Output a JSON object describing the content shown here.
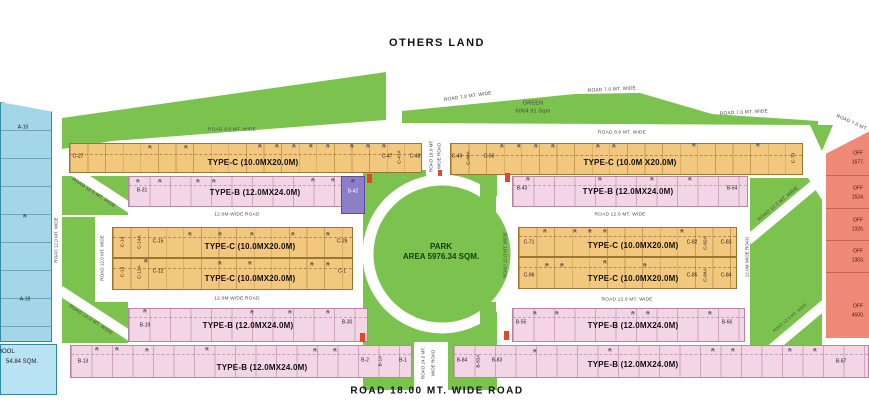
{
  "labels": {
    "others_land": "OTHERS LAND",
    "r": "R",
    "bottom_road": "ROAD 18.00 MT. WIDE ROAD",
    "green_name": "GREEN",
    "green_area": "6064.91 Sqm",
    "park1": "PARK",
    "park2": "AREA 5976.34 SQM."
  },
  "roads": {
    "r7": "ROAD 7.0 MT. WIDE",
    "r8": "ROAD 8.0 MT. WIDE",
    "r9": "ROAD 9.0 MT. WIDE",
    "r12": "ROAD 12.0 MT. WIDE",
    "w12": "12.0M WIDE ROAD",
    "r18a": "ROAD 18.0 MT.",
    "r18b": "WIDE ROAD",
    "r24a": "ROAD 24.0 MT.",
    "r24b": "WIDE ROAD"
  },
  "types": {
    "tc": "TYPE-C (10.0MX20.0M)",
    "tcs": "TYPE-C (10.0M X20.0M)",
    "tb": "TYPE-B (12.0MX24.0M)"
  },
  "plots": {
    "c27": "C-27",
    "c47": "C-47",
    "c47a": "C-47A",
    "c48": "C-48",
    "c49": "C-49",
    "c49a": "C-49A",
    "c50": "C-50",
    "c70": "C-70",
    "c14": "C-14",
    "c14a": "C-14A",
    "c15": "C-15",
    "c26": "C-26",
    "c13": "C-13",
    "c12a": "C-12A",
    "c12": "C-12",
    "c1": "C-1",
    "c71": "C-71",
    "c82": "C-82",
    "c82a": "C-82A",
    "c83": "C-83",
    "c96": "C-96",
    "c85": "C-85",
    "c84a": "C-84A",
    "c84": "C-84",
    "b31": "B-31",
    "b42": "B-42",
    "b43": "B-43",
    "b54": "B-54",
    "b19": "B-19",
    "b30": "B-30",
    "b55": "B-55",
    "b66": "B-66",
    "b13": "B-13",
    "b2": "B-2",
    "b1a": "B-1A",
    "b1": "B-1",
    "b84": "B-84",
    "b83a": "B-83A",
    "b83": "B-83",
    "b67": "B-67"
  },
  "left_zone": {
    "a10": "A-10",
    "a18": "A-18",
    "school_name": "SCHOOL",
    "school_area": "54.84 SQM."
  },
  "right_zone": {
    "offices": [
      {
        "name": "OFF",
        "area": "1677."
      },
      {
        "name": "OFF",
        "area": "1524."
      },
      {
        "name": "OFF",
        "area": "1326."
      },
      {
        "name": "OFF",
        "area": "1303."
      },
      {
        "name": "OFF",
        "area": "4500."
      }
    ]
  },
  "colors": {
    "green": "#7cc24e",
    "orange": "#f2c77e",
    "pink": "#f2d6e6",
    "purple": "#8d7fc7",
    "blue": "#a3d7e8",
    "salmon": "#ef8a76",
    "red": "#e8432e"
  }
}
